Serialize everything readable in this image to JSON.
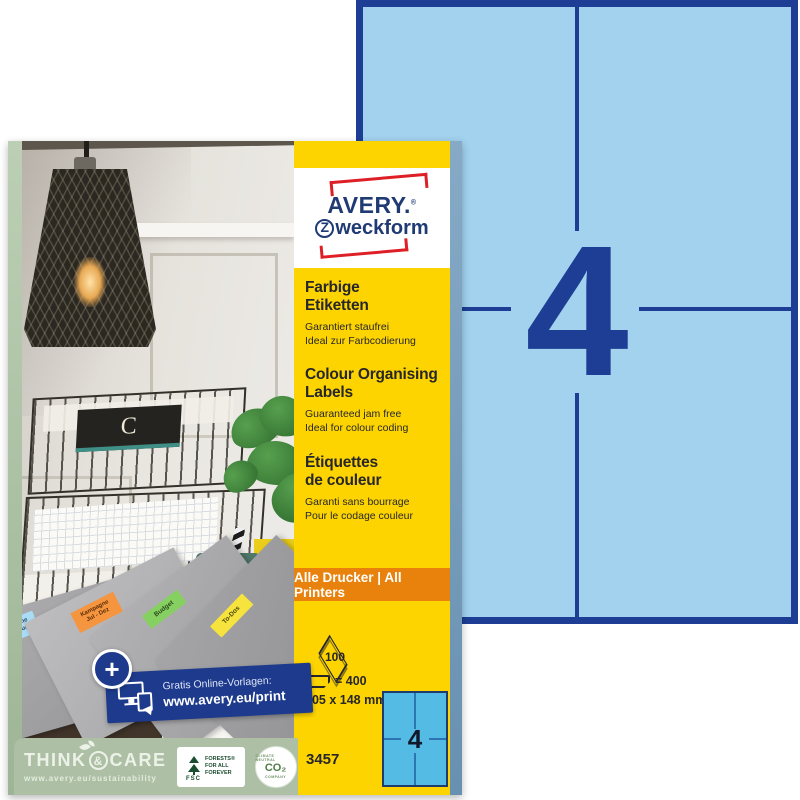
{
  "colors": {
    "sheet_fill": "#a2d2ee",
    "sheet_line": "#1d3e94",
    "strip_yellow": "#fdd400",
    "printers_orange": "#e8820c",
    "brand_navy": "#203a75",
    "brand_red": "#de1f26",
    "footer_green": "#adc0a5",
    "banner_blue": "#1d3a8c",
    "mini_sheet_fill": "#54bbe4",
    "label_blue": "#aadcf5",
    "label_orange": "#f5953f",
    "label_green": "#86d062",
    "label_yellow": "#f6e33d"
  },
  "big_sheet": {
    "count": "4"
  },
  "strip": {
    "logo": {
      "line1": "AVERY.",
      "reg": "®",
      "z": "Z",
      "line2": "weckform"
    },
    "sections": [
      {
        "heading": "Farbige\nEtiketten",
        "sub1": "Garantiert staufrei",
        "sub2": "Ideal zur Farbcodierung"
      },
      {
        "heading": "Colour Organising\nLabels",
        "sub1": "Guaranteed jam free",
        "sub2": "Ideal for colour coding"
      },
      {
        "heading": "Étiquettes\nde couleur",
        "sub1": "Garanti sans bourrage",
        "sub2": "Pour le codage couleur"
      }
    ],
    "printers": "Alle Drucker | All Printers",
    "specs": {
      "sheet_count": "100",
      "label_count": "= 400",
      "size": "105 x 148 mm"
    },
    "mini_sheet_count": "4",
    "sku": "3457"
  },
  "photo": {
    "cup": "HEY",
    "notebook": "C",
    "folders": [
      {
        "label": "Kampagne\nJan – Jun"
      },
      {
        "label": "Kampagne\nJul - Dez"
      },
      {
        "label": "Budget"
      },
      {
        "label": "To-Dos"
      }
    ],
    "banner": {
      "plus": "+",
      "line1": "Gratis Online-Vorlagen:",
      "line2": "www.avery.eu/print"
    }
  },
  "footer": {
    "think": "THINK",
    "amp": "&",
    "care": "CARE",
    "url": "www.avery.eu/sustainability",
    "fsc": {
      "abbr": "FSC",
      "lines": "FORESTS®\nFOR ALL\nFOREVER"
    },
    "co2": {
      "top": "CLIMATE NEUTRAL",
      "label": "CO₂",
      "bottom": "COMPANY"
    }
  }
}
